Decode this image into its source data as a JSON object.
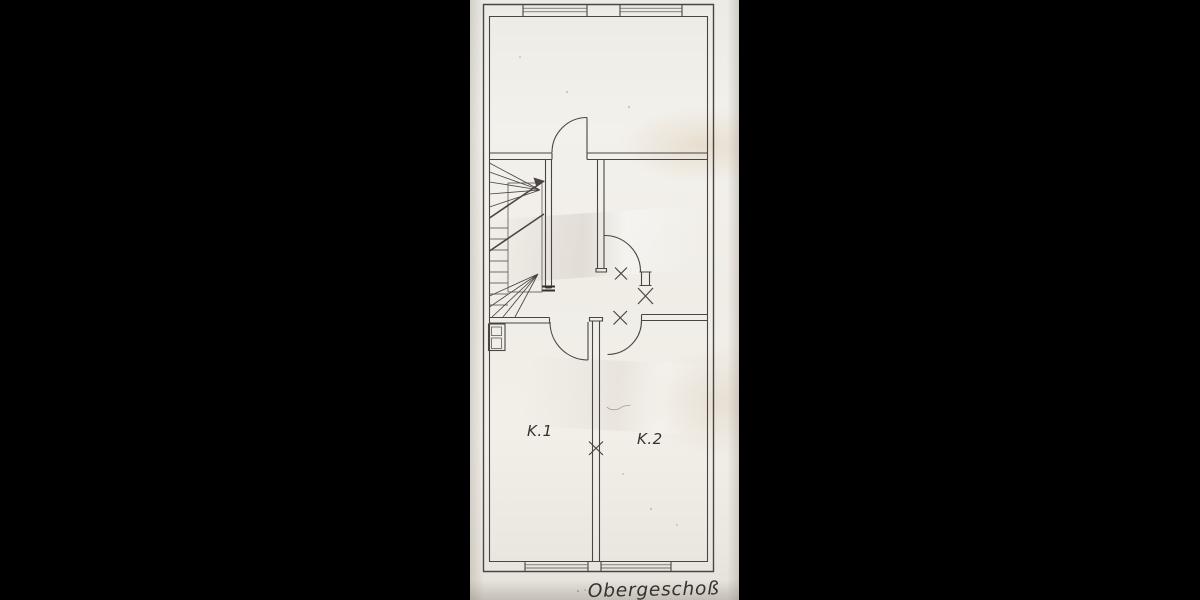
{
  "plan": {
    "floor_label": "Obergeschoß",
    "rooms": [
      {
        "id": "k1",
        "label": "K.1"
      },
      {
        "id": "k2",
        "label": "K.2"
      }
    ]
  },
  "colors": {
    "background": "#000000",
    "paper": "#f1efe9",
    "ink": "#4a4542",
    "ink_dark": "#34302c"
  }
}
